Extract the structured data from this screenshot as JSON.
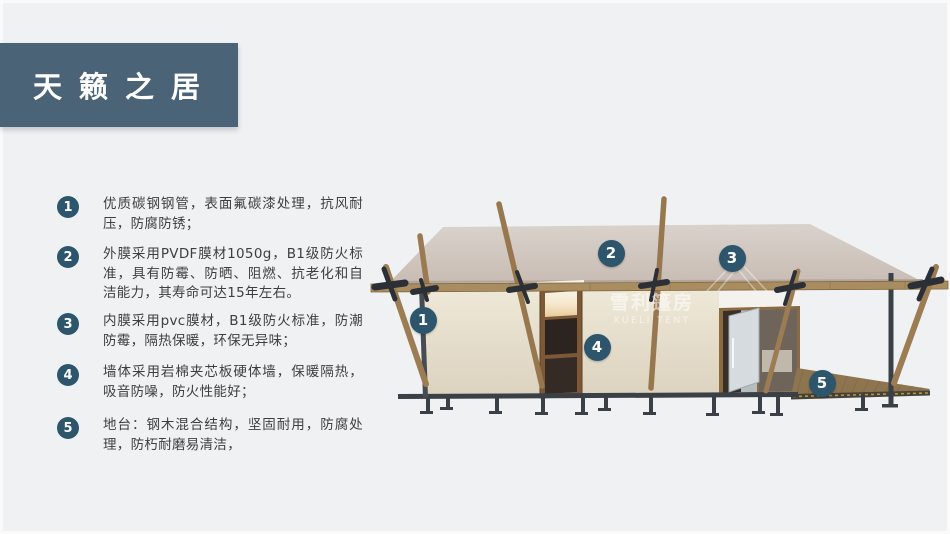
{
  "title_box": {
    "label": "天籁之居"
  },
  "features": [
    {
      "num": "1",
      "text": "优质碳钢钢管，表面氟碳漆处理，抗风耐压，防腐防锈；"
    },
    {
      "num": "2",
      "text": "外膜采用PVDF膜材1050g，B1级防火标准，具有防霉、防晒、阻燃、抗老化和自洁能力，其寿命可达15年左右。"
    },
    {
      "num": "3",
      "text": "内膜采用pvc膜材，B1级防火标准，防潮防霉，隔热保暖，环保无异味；"
    },
    {
      "num": "4",
      "text": "墙体采用岩棉夹芯板硬体墙，保暖隔热，吸音防噪，防火性能好；"
    },
    {
      "num": "5",
      "text": "地台：钢木混合结构，坚固耐用，防腐处理，防朽耐磨易清洁，"
    }
  ],
  "diagram": {
    "badges": [
      "1",
      "2",
      "3",
      "4",
      "5"
    ],
    "watermark": {
      "cn": "雪利篷房",
      "en": "XUELI TENT"
    }
  },
  "colors": {
    "background": "#f0f1f2",
    "title_bg": "#4b6377",
    "badge_bg": "#2d566c",
    "roof": "#cfc5bd",
    "wall": "#e9e2d1",
    "wood_beam": "#a98c5f",
    "metal_frame": "#3a4046",
    "deck_wood": "#8e7550"
  }
}
